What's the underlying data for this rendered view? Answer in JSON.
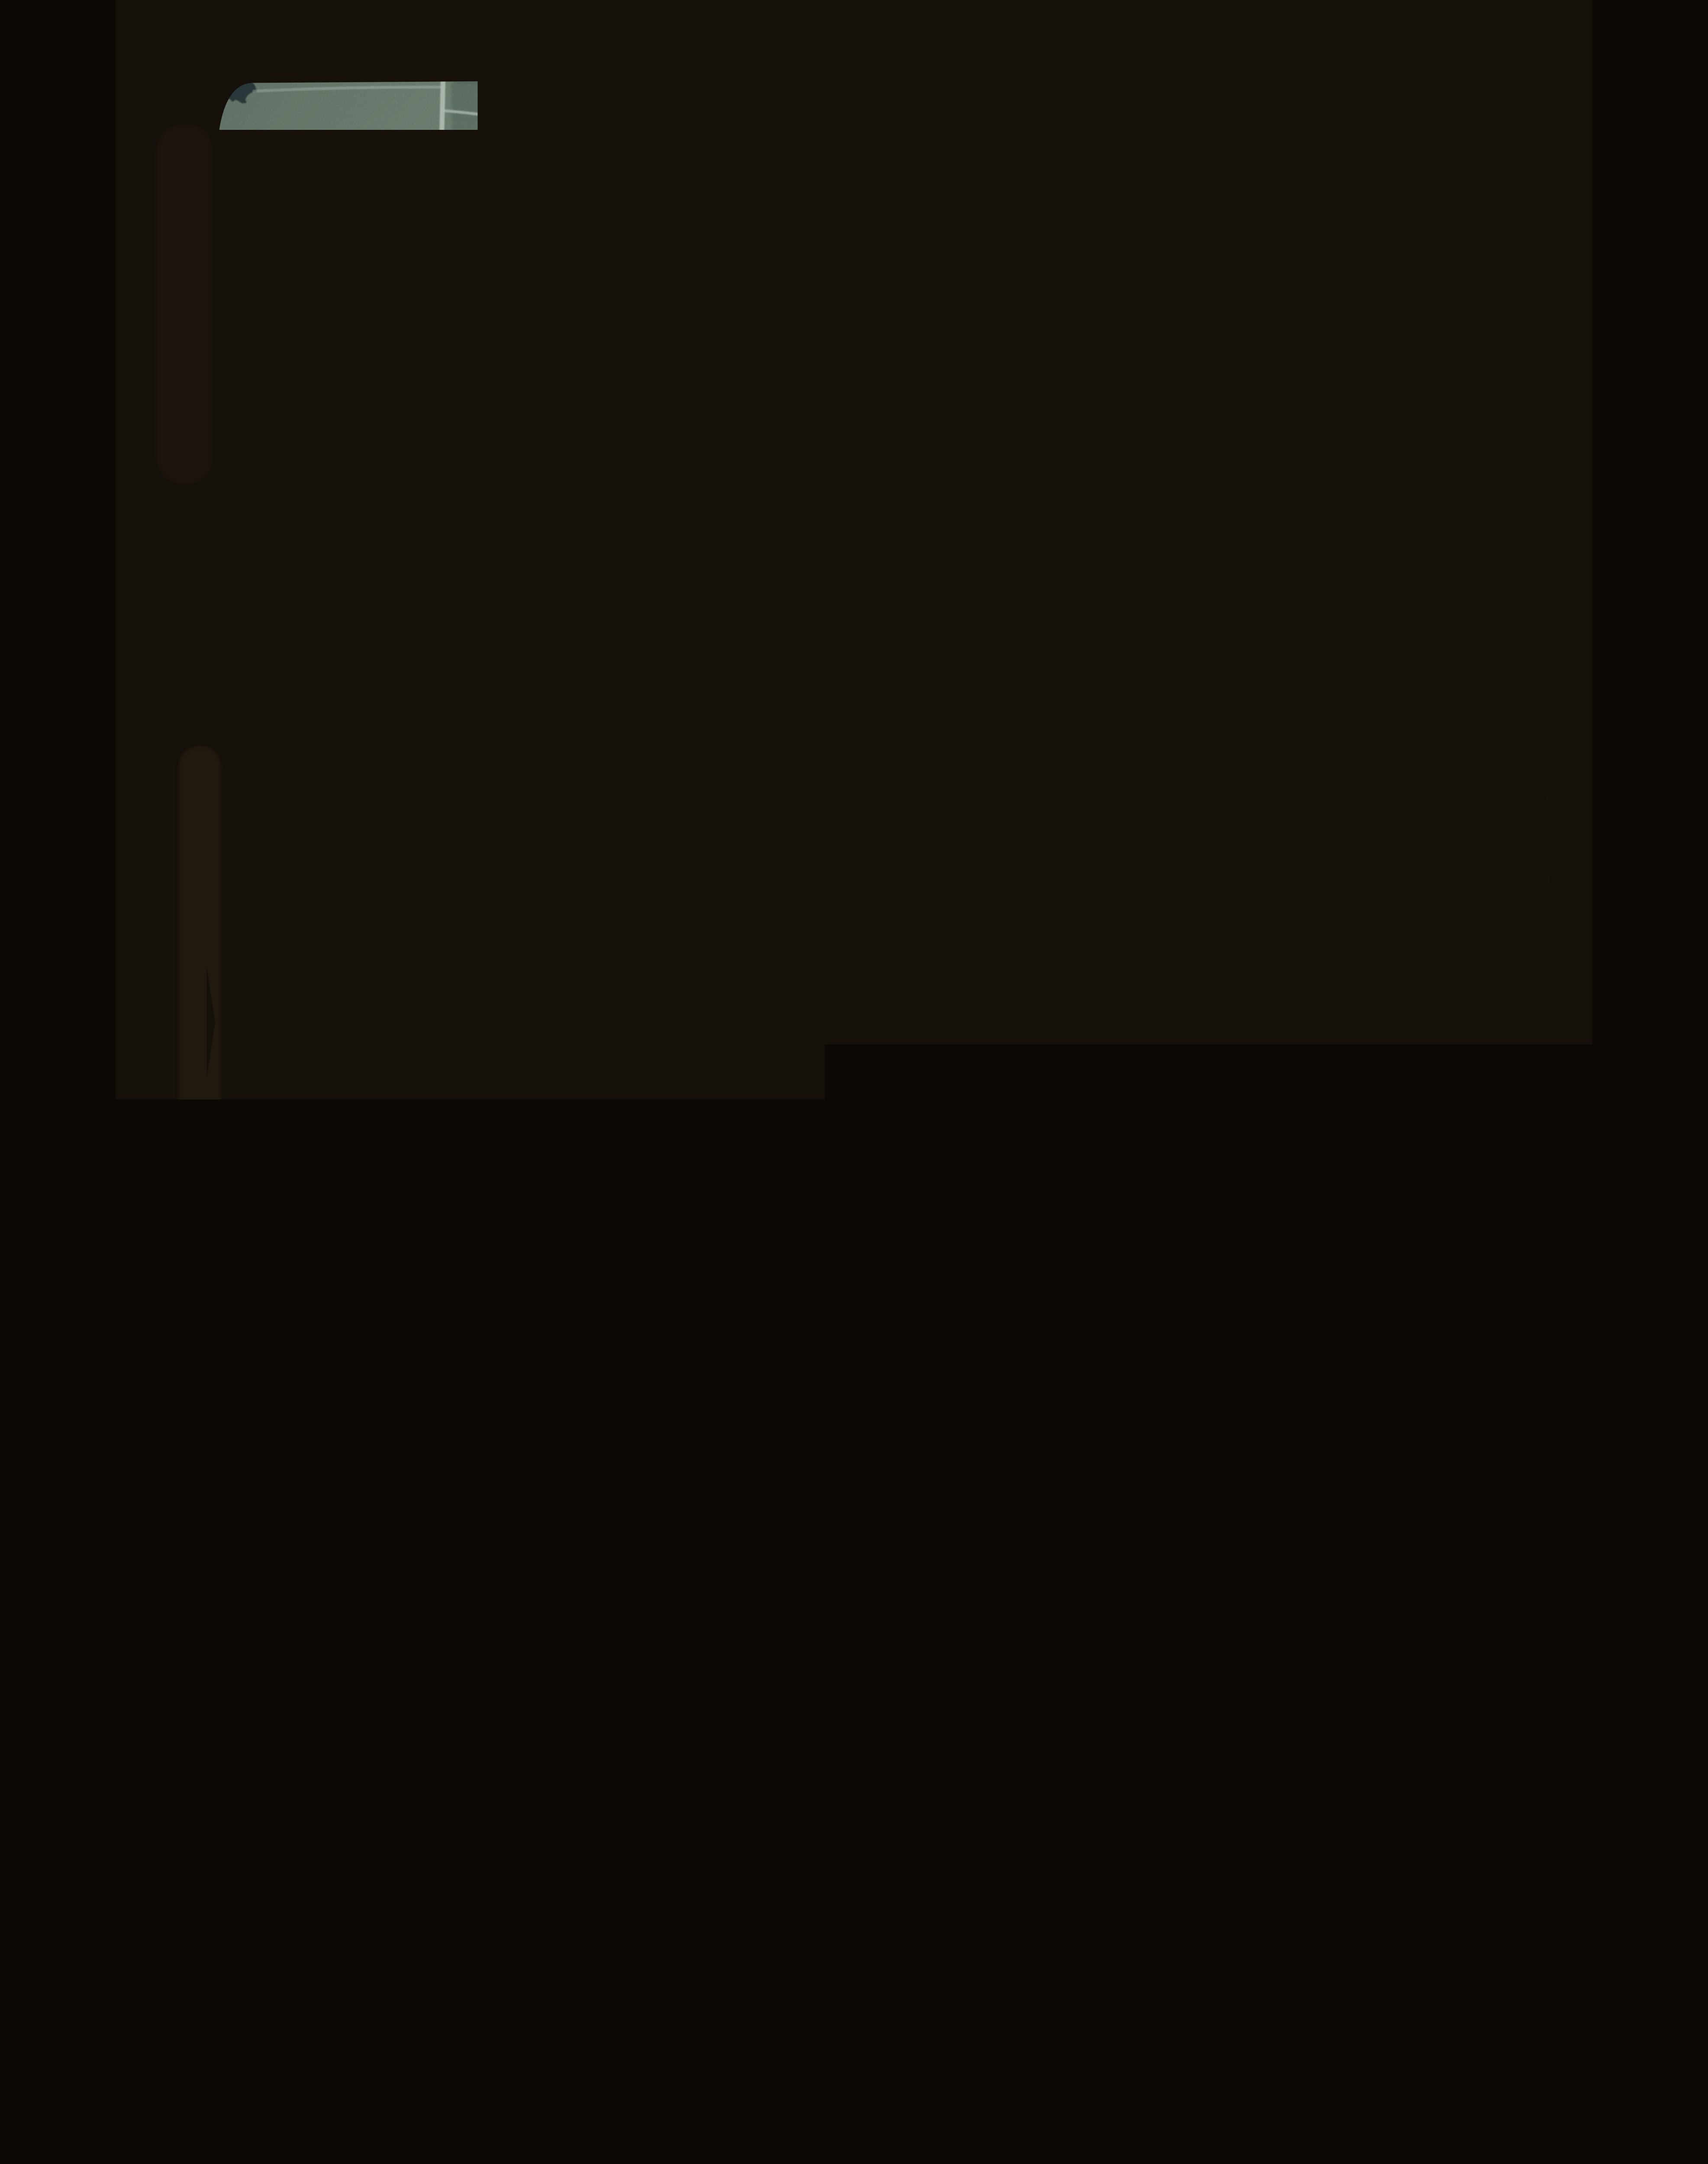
{
  "scene": {
    "type": "aerial-photograph-slide",
    "description": "Scanned color slide of a vertical aerial photograph: glaciated farmland patchwork with kettle lakes, dark woodlots, tan crop fields, white gravel section roads and scattered farmsteads, inside a dark film mount with rounded corners",
    "orientation": "portrait"
  },
  "palette": {
    "mount": "#15100a",
    "mount_bottom": "#0f0b06",
    "mount_edge": "#261b0e",
    "leak": "#4a3a20",
    "photo_base": "#5f7166",
    "field_light": "#78897b",
    "field_pale": "#87977f",
    "field_mid": "#68796d",
    "field_dark": "#515f58",
    "field_olive": "#5d6b58",
    "field_bluegray": "#59675f",
    "marsh": "#7d8e80",
    "tan": "#958d69",
    "tan_bright": "#a59c77",
    "tan_pale": "#9aa183",
    "brown": "#80755a",
    "brown_light": "#7b7560",
    "water": "#61736a",
    "water_low": "#5a6b60",
    "water_mid": "#46525a",
    "water_dark": "#3e4a52",
    "water_darkest": "#303b43",
    "forest": "#2f3e43",
    "forest_dark": "#27343a",
    "road": "#c6d2c6",
    "building": "#e6ede9",
    "speck": "#1c170e"
  },
  "features": {
    "water": [
      "big-lake",
      "lower-lake",
      "kettle-pond-ne",
      "center-pond-west",
      "center-pond-east",
      "dark-pond-west",
      "round-pond-north",
      "marsh-pond-top",
      "small-pond-pair",
      "edge-pond-east"
    ],
    "forest": [
      "central-woodlot",
      "lakeshore-fringe",
      "east-woodlot",
      "bottom-right-woodlot",
      "bottom-center-woodlot",
      "lower-lake-woods",
      "farm-groves",
      "hedgerows"
    ],
    "roads": [
      "west-section-road",
      "main-crossroad",
      "center-section-road",
      "north-road",
      "northeast-road",
      "bottom-diagonal-road",
      "farm-lanes"
    ],
    "farms": [
      "farm-top-left",
      "farm-north-center",
      "farm-lakeside",
      "farm-west-pond",
      "farm-center",
      "farm-bottom-left",
      "farm-bottom-center",
      "farm-bottom-right"
    ],
    "film": [
      "slide-mount",
      "rounded-corners",
      "dust-specks",
      "film-grain",
      "light-leak"
    ]
  }
}
